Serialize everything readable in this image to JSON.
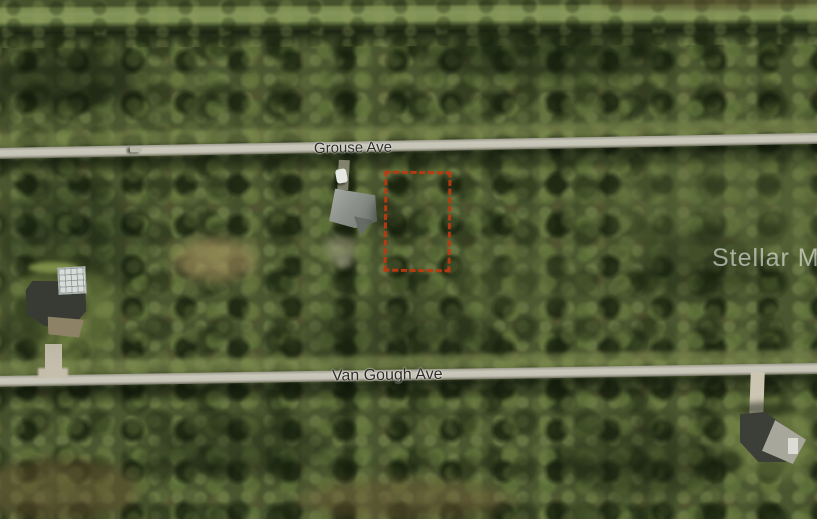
{
  "map": {
    "view": "satellite-aerial-photo",
    "watermark": "Stellar MLS",
    "roads": [
      {
        "id": "grouse-ave",
        "name": "Grouse Ave"
      },
      {
        "id": "van-gough-ave",
        "name": "Van Gough Ave"
      }
    ],
    "parcel_outline": {
      "description": "subject vacant lot boundary on north side between Grouse Ave and Van Gough Ave",
      "color": "#c1380f"
    },
    "colors": {
      "road_surface": "#c6c4b6",
      "road_label_text": "#2d2c28",
      "vegetation_base": "#49562f",
      "vegetation_light": "#83955a",
      "vegetation_shadow": "#1c2513",
      "watermark_text": "#ffffff"
    }
  }
}
